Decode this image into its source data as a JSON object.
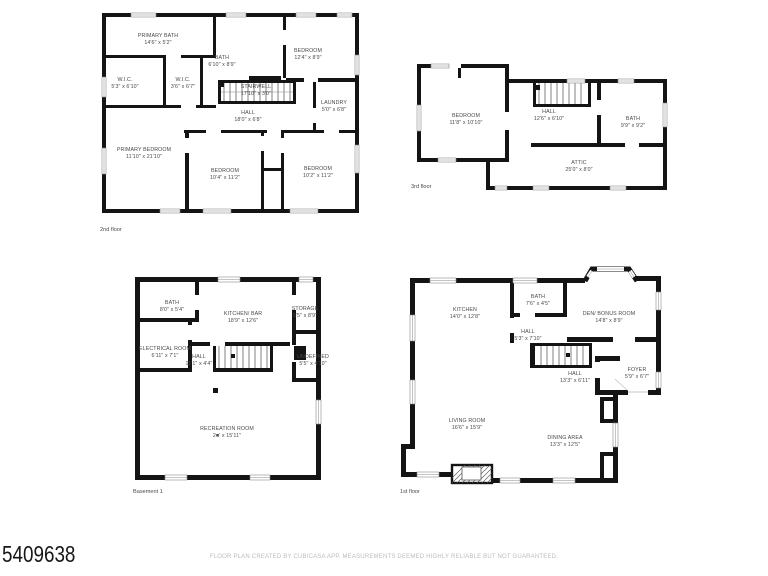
{
  "page": {
    "watermark": "5409638",
    "disclaimer": "FLOOR PLAN CREATED BY CUBICASA APP. MEASUREMENTS DEEMED HIGHLY RELIABLE BUT NOT GUARANTEED."
  },
  "colors": {
    "wall": "#141414",
    "room_text": "#4a4a4a",
    "disclaimer_text": "#bcbcbc",
    "background": "#ffffff"
  },
  "floors": [
    {
      "label": "2nd floor",
      "rooms": [
        {
          "name": "PRIMARY BATH",
          "dims": "14'6\" x 5'2\""
        },
        {
          "name": "BATH",
          "dims": "6'10\" x 8'9\""
        },
        {
          "name": "BEDROOM",
          "dims": "12'4\" x 8'9\""
        },
        {
          "name": "W.I.C.",
          "dims": "5'3\" x 6'10\""
        },
        {
          "name": "W.I.C.",
          "dims": "3'6\" x 6'7\""
        },
        {
          "name": "STAIRWELL",
          "dims": "17'10\" x 3'0\""
        },
        {
          "name": "LAUNDRY",
          "dims": "5'0\" x 6'8\""
        },
        {
          "name": "HALL",
          "dims": "18'0\" x 6'8\""
        },
        {
          "name": "PRIMARY BEDROOM",
          "dims": "11'10\" x 21'10\""
        },
        {
          "name": "BEDROOM",
          "dims": "10'4\" x 11'2\""
        },
        {
          "name": "BEDROOM",
          "dims": "10'2\" x 11'2\""
        }
      ]
    },
    {
      "label": "3rd floor",
      "rooms": [
        {
          "name": "BEDROOM",
          "dims": "11'8\" x 10'10\""
        },
        {
          "name": "HALL",
          "dims": "12'6\" x 6'10\""
        },
        {
          "name": "BATH",
          "dims": "9'9\" x 9'2\""
        },
        {
          "name": "ATTIC",
          "dims": "25'0\" x 8'0\""
        }
      ]
    },
    {
      "label": "Basement 1",
      "rooms": [
        {
          "name": "BATH",
          "dims": "8'0\" x 5'4\""
        },
        {
          "name": "KITCHEN/ BAR",
          "dims": "18'9\" x 12'6\""
        },
        {
          "name": "STORAGE",
          "dims": "5'5\" x 8'9\""
        },
        {
          "name": "ELECTRICAL ROOM",
          "dims": "6'11\" x 7'1\""
        },
        {
          "name": "HALL",
          "dims": "11'1\" x 4'4\""
        },
        {
          "name": "UNDEFINED",
          "dims": "5'5\" x 4'10\""
        },
        {
          "name": "RECREATION ROOM",
          "dims": "2■' x 15'11\""
        }
      ]
    },
    {
      "label": "1st floor",
      "rooms": [
        {
          "name": "KITCHEN",
          "dims": "14'0\" x 12'8\""
        },
        {
          "name": "BATH",
          "dims": "7'6\" x 4'5\""
        },
        {
          "name": "DEN/ BONUS ROOM",
          "dims": "14'8\" x 8'9\""
        },
        {
          "name": "HALL",
          "dims": "5'3\" x 7'10\""
        },
        {
          "name": "HALL",
          "dims": "13'3\" x 6'11\""
        },
        {
          "name": "FOYER",
          "dims": "5'9\" x 6'7\""
        },
        {
          "name": "LIVING ROOM",
          "dims": "16'6\" x 15'9\""
        },
        {
          "name": "DINING AREA",
          "dims": "13'3\" x 12'5\""
        }
      ]
    }
  ]
}
